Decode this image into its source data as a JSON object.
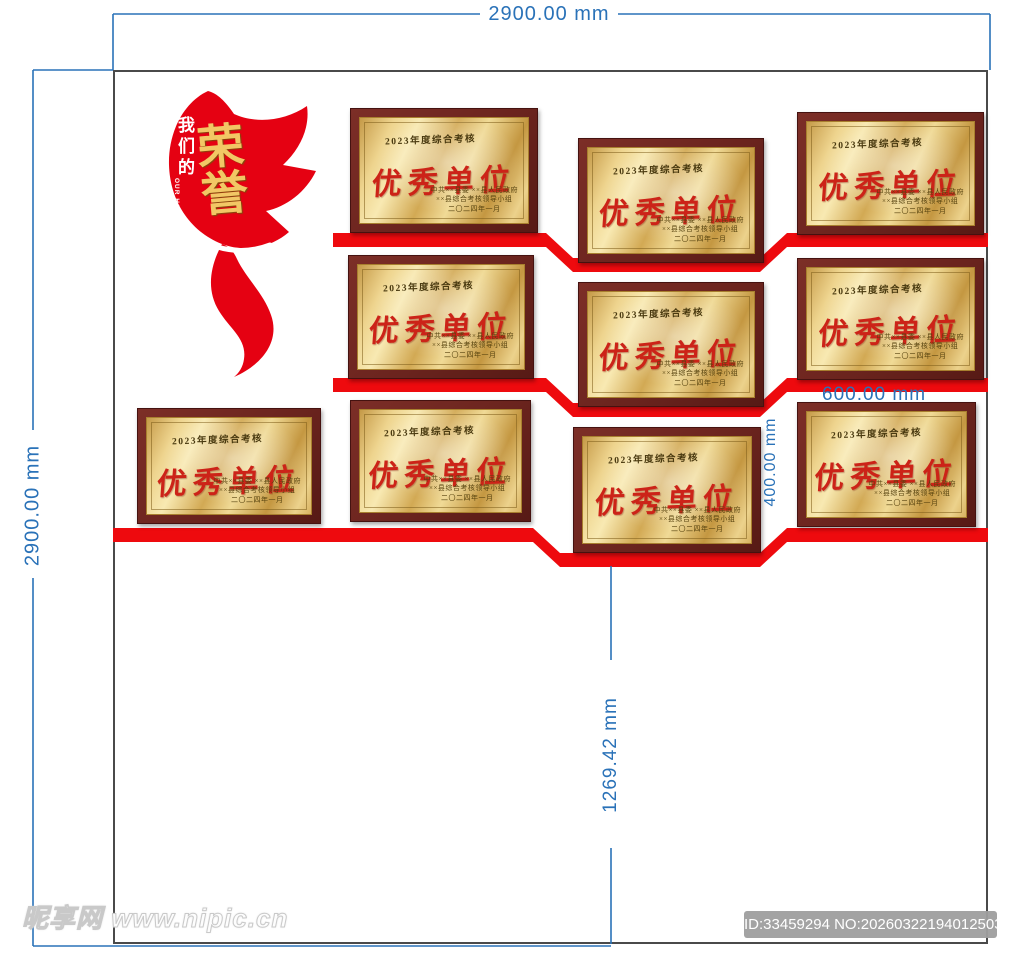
{
  "dims": {
    "top_width": "2900.00 mm",
    "left_height": "2900.00 mm",
    "plaque_width": "600.00 mm",
    "gap_height": "400.00 mm",
    "bottom_height": "1269.42 mm"
  },
  "honor_flag": {
    "prefix": "我们的",
    "prefix_en": "OUR HONOR",
    "word": "荣誉"
  },
  "plaque": {
    "heading": "2023年度综合考核",
    "title": "优秀单位",
    "issuer_line1": "中共××县委 ××县人民政府",
    "issuer_line2": "××县综合考核领导小组",
    "date_line": "二〇二四年一月"
  },
  "watermarks": {
    "site": "昵享网 www.nipic.cn",
    "id_number": "ID:33459294 NO:20260322194012503108"
  },
  "colors": {
    "dimension_blue": "#2a72b8",
    "shelf_red": "#ee0a0e",
    "flag_red": "#e50112",
    "plaque_frame_brown": "#6b241e",
    "plate_gold": "#eed48e",
    "award_text_red": "#cc2318",
    "wall_border_gray": "#4a4a4a"
  }
}
